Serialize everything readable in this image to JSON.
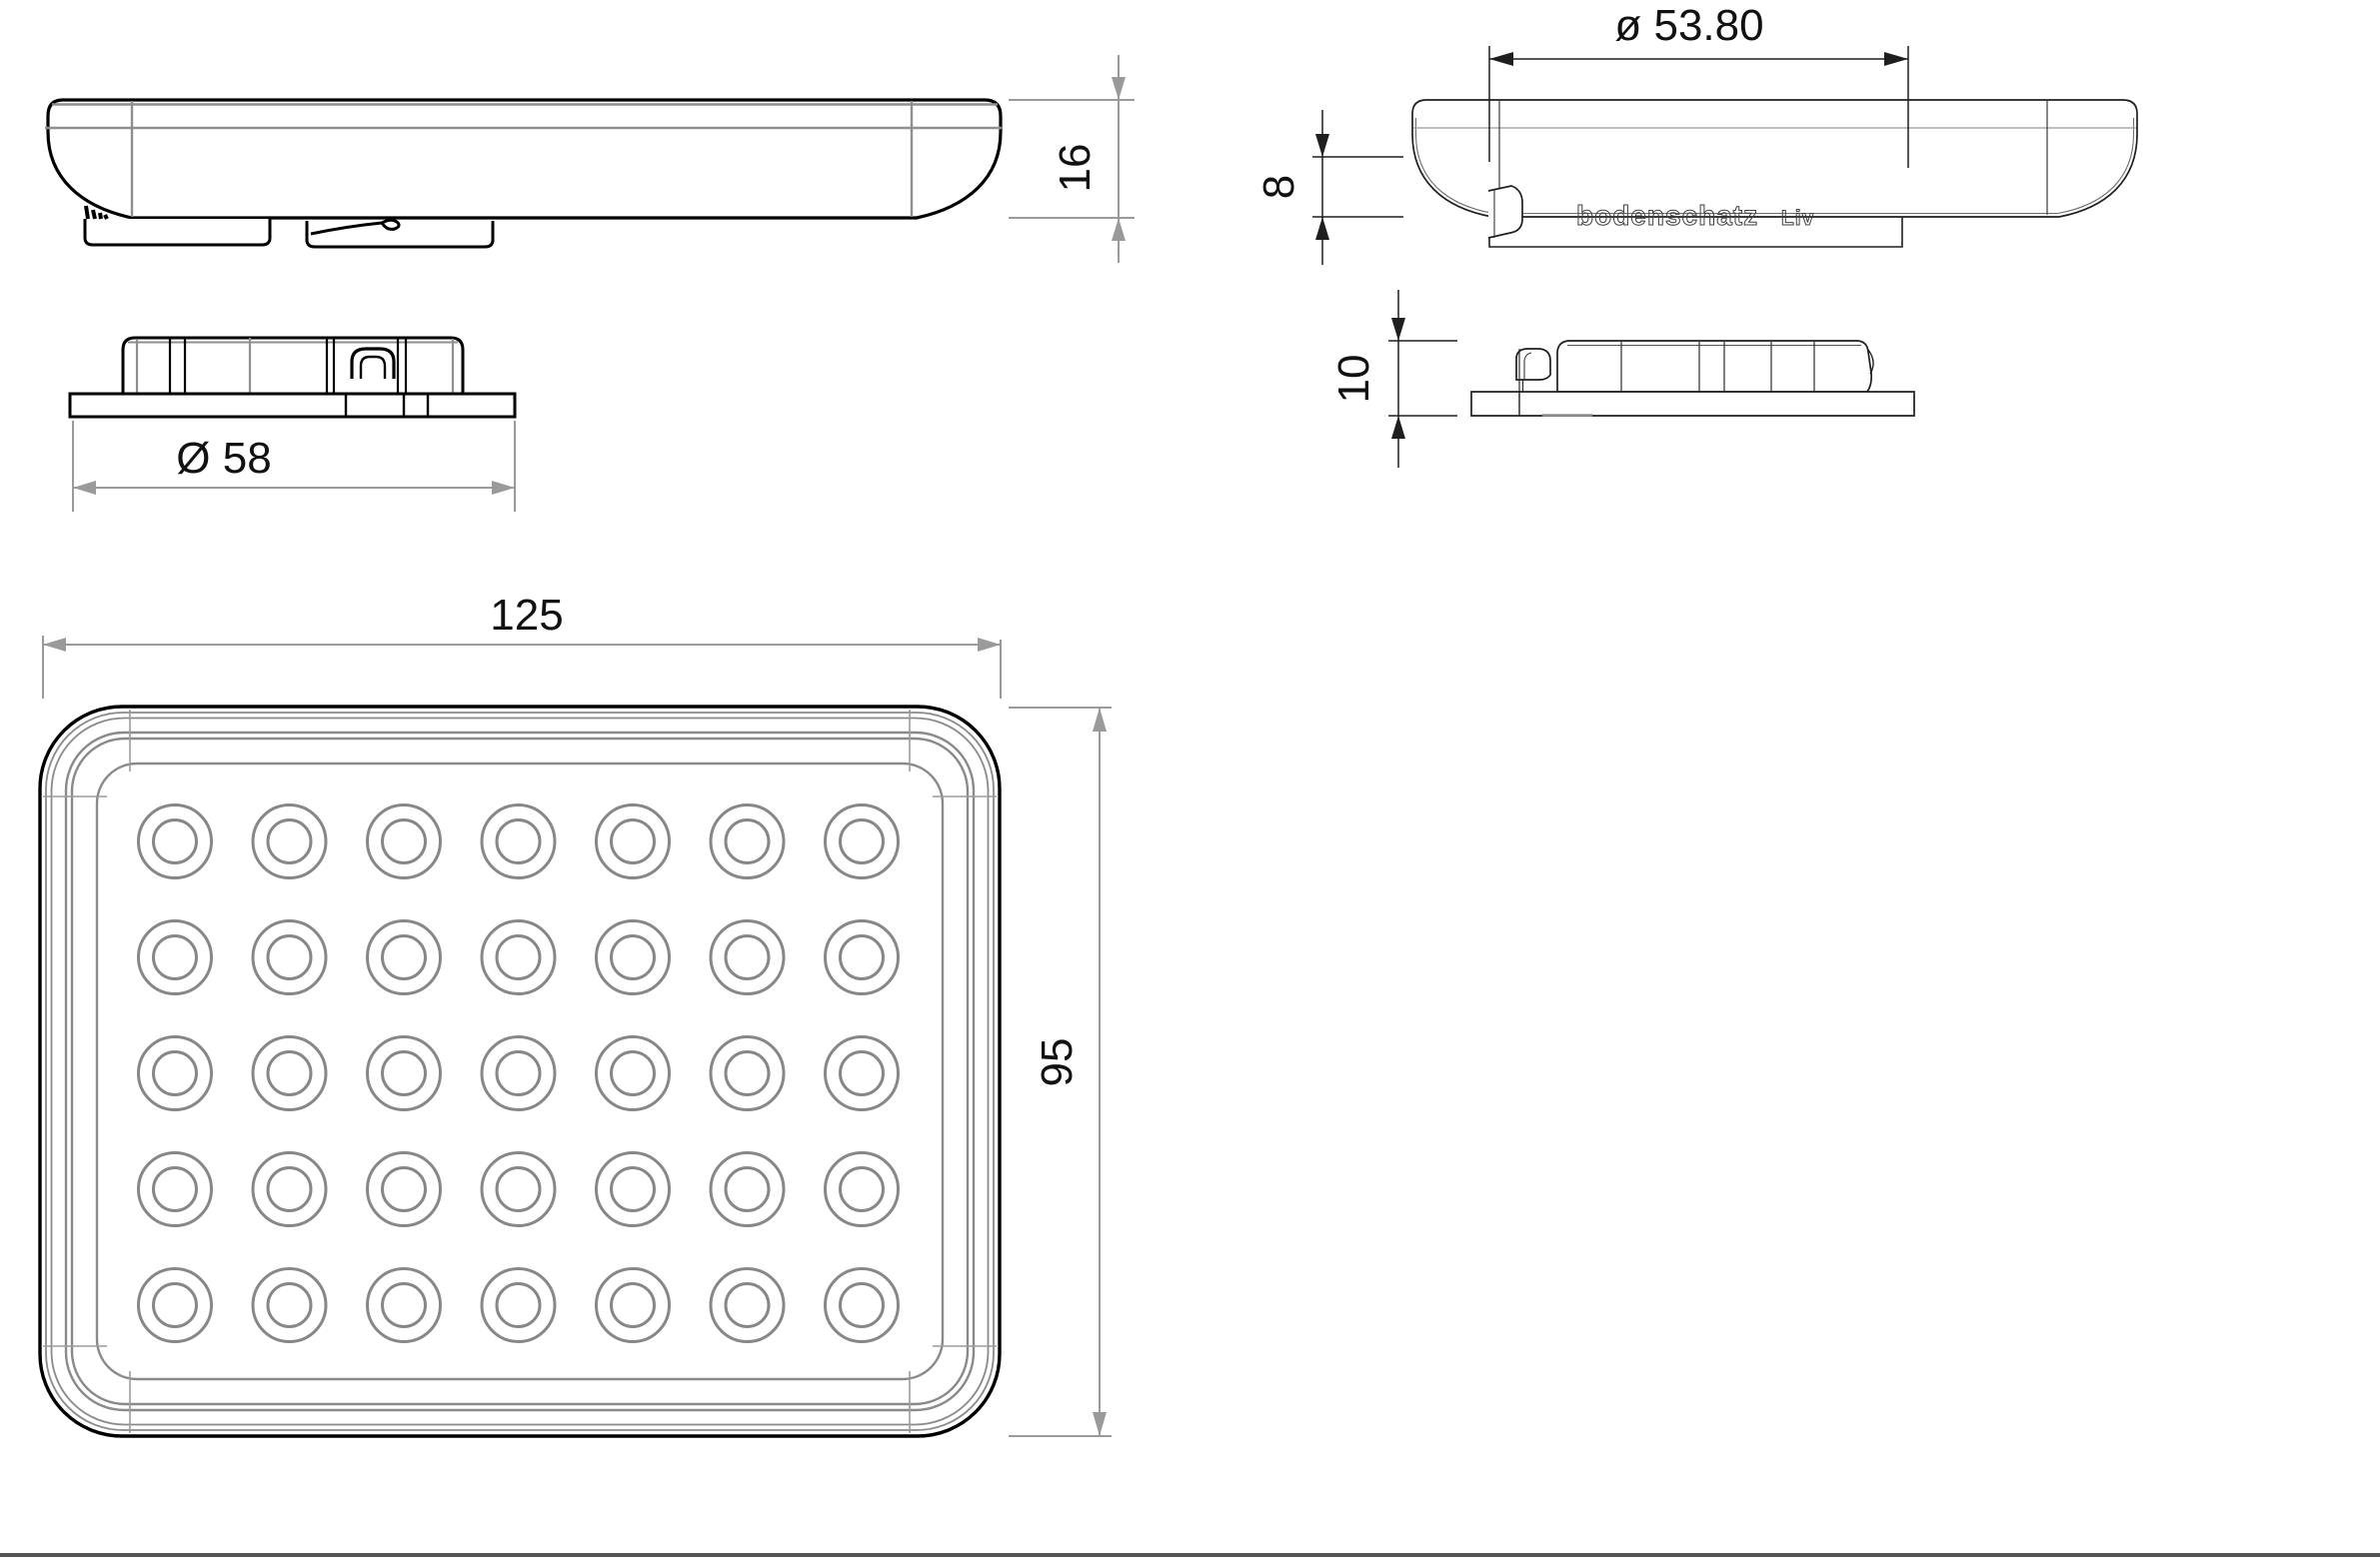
{
  "drawing": {
    "brand": {
      "name": "bodenschatz",
      "series": "Liv"
    },
    "dimensions": {
      "body_height": "16",
      "plate_diameter": "Ø 58",
      "seat_diameter": "ø 53.80",
      "recess_depth": "8",
      "plate_height": "10",
      "overall_width": "125",
      "overall_depth": "95"
    },
    "bump_grid": {
      "cols": 7,
      "rows": 5,
      "cx0": 175,
      "cy0": 842,
      "dx": 114.5,
      "dy": 116,
      "r_outer": 36.5,
      "r_inner": 21.5,
      "stroke": "#878787",
      "stroke_width": 3
    },
    "colors": {
      "line_black": "#000000",
      "line_thin": "#1f1f1f",
      "line_gray": "#8a8a8a",
      "dim_gray": "#999999",
      "text": "#111111",
      "border_bottom": "#555555"
    }
  }
}
